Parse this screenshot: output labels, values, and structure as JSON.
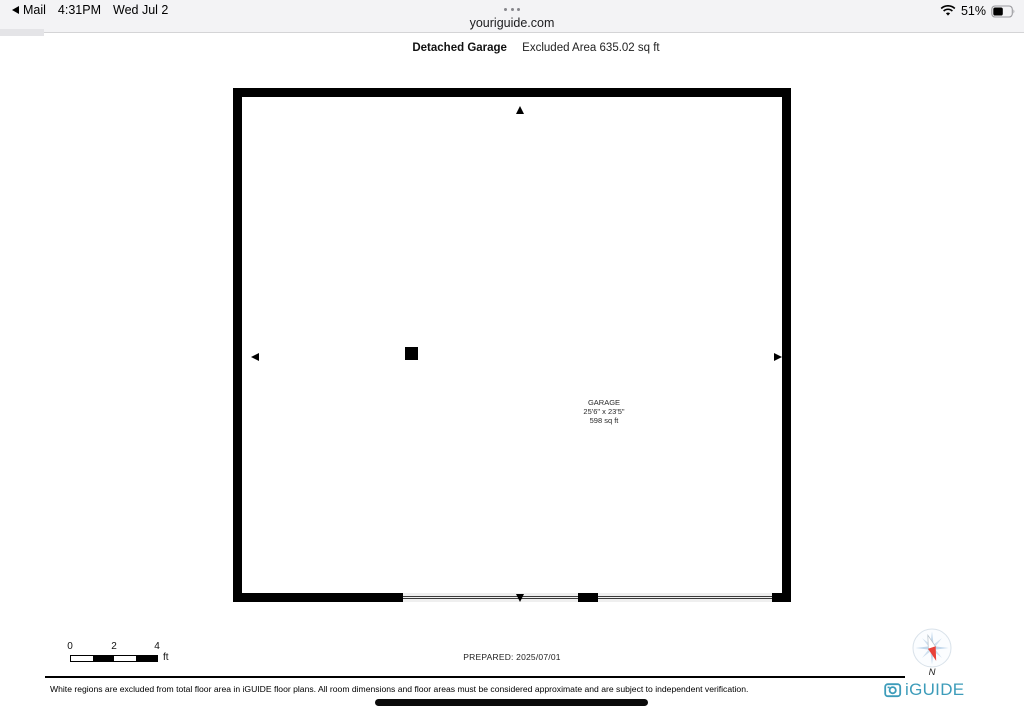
{
  "status_bar": {
    "back_app": "Mail",
    "time": "4:31PM",
    "date": "Wed Jul 2",
    "battery_percent": "51%",
    "icons": {
      "back": "back-triangle-icon",
      "wifi": "wifi-icon",
      "battery": "battery-icon",
      "page_menu": "ellipsis-dots-icon"
    }
  },
  "browser": {
    "url": "youriguide.com"
  },
  "header": {
    "title": "Detached Garage",
    "excluded_area": "Excluded Area 635.02 sq ft"
  },
  "floorplan": {
    "room": {
      "name": "GARAGE",
      "dimensions": "25'6\" x 23'5\"",
      "area": "598 sq ft"
    },
    "wall_color": "#000000"
  },
  "scale_bar": {
    "labels": [
      "0",
      "2",
      "4"
    ],
    "unit": "ft"
  },
  "prepared_label": "PREPARED: 2025/07/01",
  "compass": {
    "north_label": "N",
    "needle_red": "#e8423a",
    "rose_blue": "#c2d8ec"
  },
  "footer": {
    "disclaimer": "White regions are excluded from total floor area in iGUIDE floor plans. All room dimensions and floor areas must be considered approximate and are subject to independent verification.",
    "brand": "iGUIDE",
    "brand_color": "#3d9cba"
  }
}
